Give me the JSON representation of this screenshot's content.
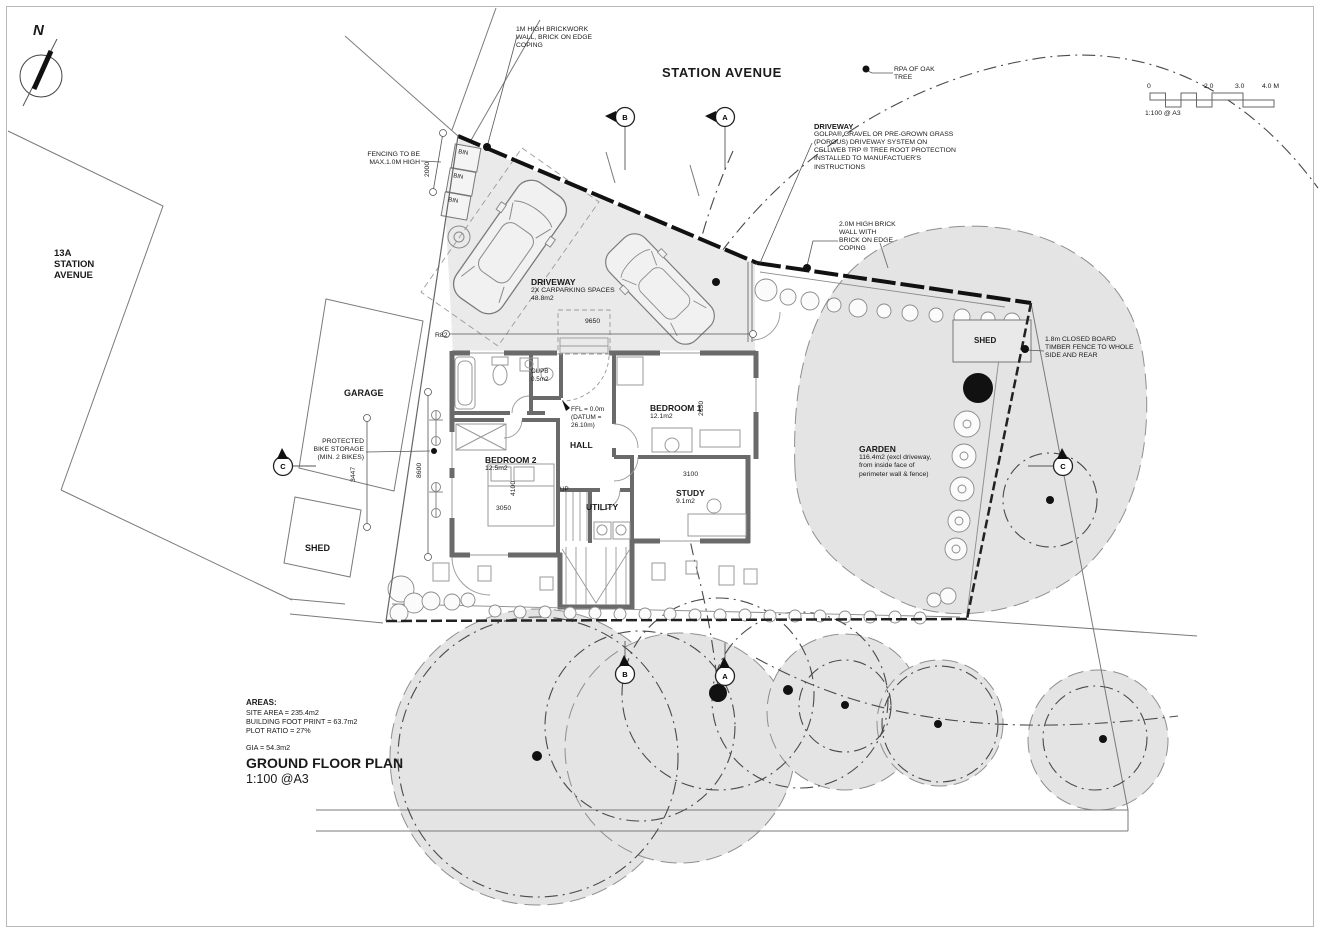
{
  "sheet": {
    "street_title": "STATION AVENUE",
    "neighbor": [
      "13A",
      "STATION",
      "AVENUE"
    ],
    "north_label": "N"
  },
  "scale_bar": {
    "t0": "0",
    "t2": "2.0",
    "t3": "3.0",
    "t4": "4.0 M",
    "note": "1:100 @ A3"
  },
  "notes": {
    "brickwork": [
      "1M HIGH BRICKWORK",
      "WALL, BRICK ON EDGE",
      "COPING"
    ],
    "fencing": [
      "FENCING TO BE",
      "MAX.1.0M HIGH"
    ],
    "rpa": [
      "RPA OF  OAK",
      "TREE"
    ],
    "driveway_spec_title": "DRIVEWAY",
    "driveway_spec": [
      "GOLPA® GRAVEL OR PRE-GROWN GRASS",
      "(POROUS) DRIVEWAY SYSTEM ON",
      "CELLWEB TRP ® TREE ROOT PROTECTION",
      "INSTALLED TO MANUFACTUER'S",
      "INSTRUCTIONS"
    ],
    "brick_wall_2m": [
      "2.0M HIGH BRICK",
      "WALL WITH",
      "BRICK ON EDGE",
      "COPING"
    ],
    "timber_fence": [
      "1.8m CLOSED BOARD",
      "TIMBER FENCE TO WHOLE",
      "SIDE AND REAR"
    ],
    "bike_storage": [
      "PROTECTED",
      "BIKE STORAGE",
      "(MIN. 2 BIKES)"
    ],
    "ffl": [
      "FFL = 0.0m",
      "(DATUM =",
      "26.10m)"
    ]
  },
  "rooms": {
    "garage": "GARAGE",
    "shed_left": "SHED",
    "shed_right": "SHED",
    "driveway": "DRIVEWAY",
    "driveway_sub": [
      "2X CARPARKING SPACES",
      "48.8m2"
    ],
    "garden": "GARDEN",
    "garden_sub": [
      "116.4m2 (excl driveway,",
      "from inside face of",
      "perimeter wall & fence)"
    ],
    "bedroom1": "BEDROOM 1",
    "bedroom1_area": "12.1m2",
    "bedroom2": "BEDROOM 2",
    "bedroom2_area": "12.5m2",
    "hall": "HALL",
    "study": "STUDY",
    "study_area": "9.1m2",
    "utility": "UTILITY",
    "cupb": "CUPB",
    "cupb_area": "0.5m2",
    "up": "UP",
    "bin": "BIN"
  },
  "dims": {
    "d2000": "2000",
    "d9650": "9650",
    "r82": "R82",
    "d3447": "3447",
    "d8600": "8600",
    "d4100": "4100",
    "d3050": "3050",
    "d3100": "3100",
    "d2650": "2650"
  },
  "markers": {
    "a": "A",
    "b": "B",
    "c": "C"
  },
  "areas": {
    "title": "AREAS:",
    "site": "SITE AREA = 235.4m2",
    "footprint": "BUILDING FOOT PRINT = 63.7m2",
    "plot": "PLOT RATIO = 27%",
    "gia": "GIA = 54.3m2"
  },
  "titleblock": {
    "title": "GROUND FLOOR PLAN",
    "scale": "1:100 @A3"
  }
}
